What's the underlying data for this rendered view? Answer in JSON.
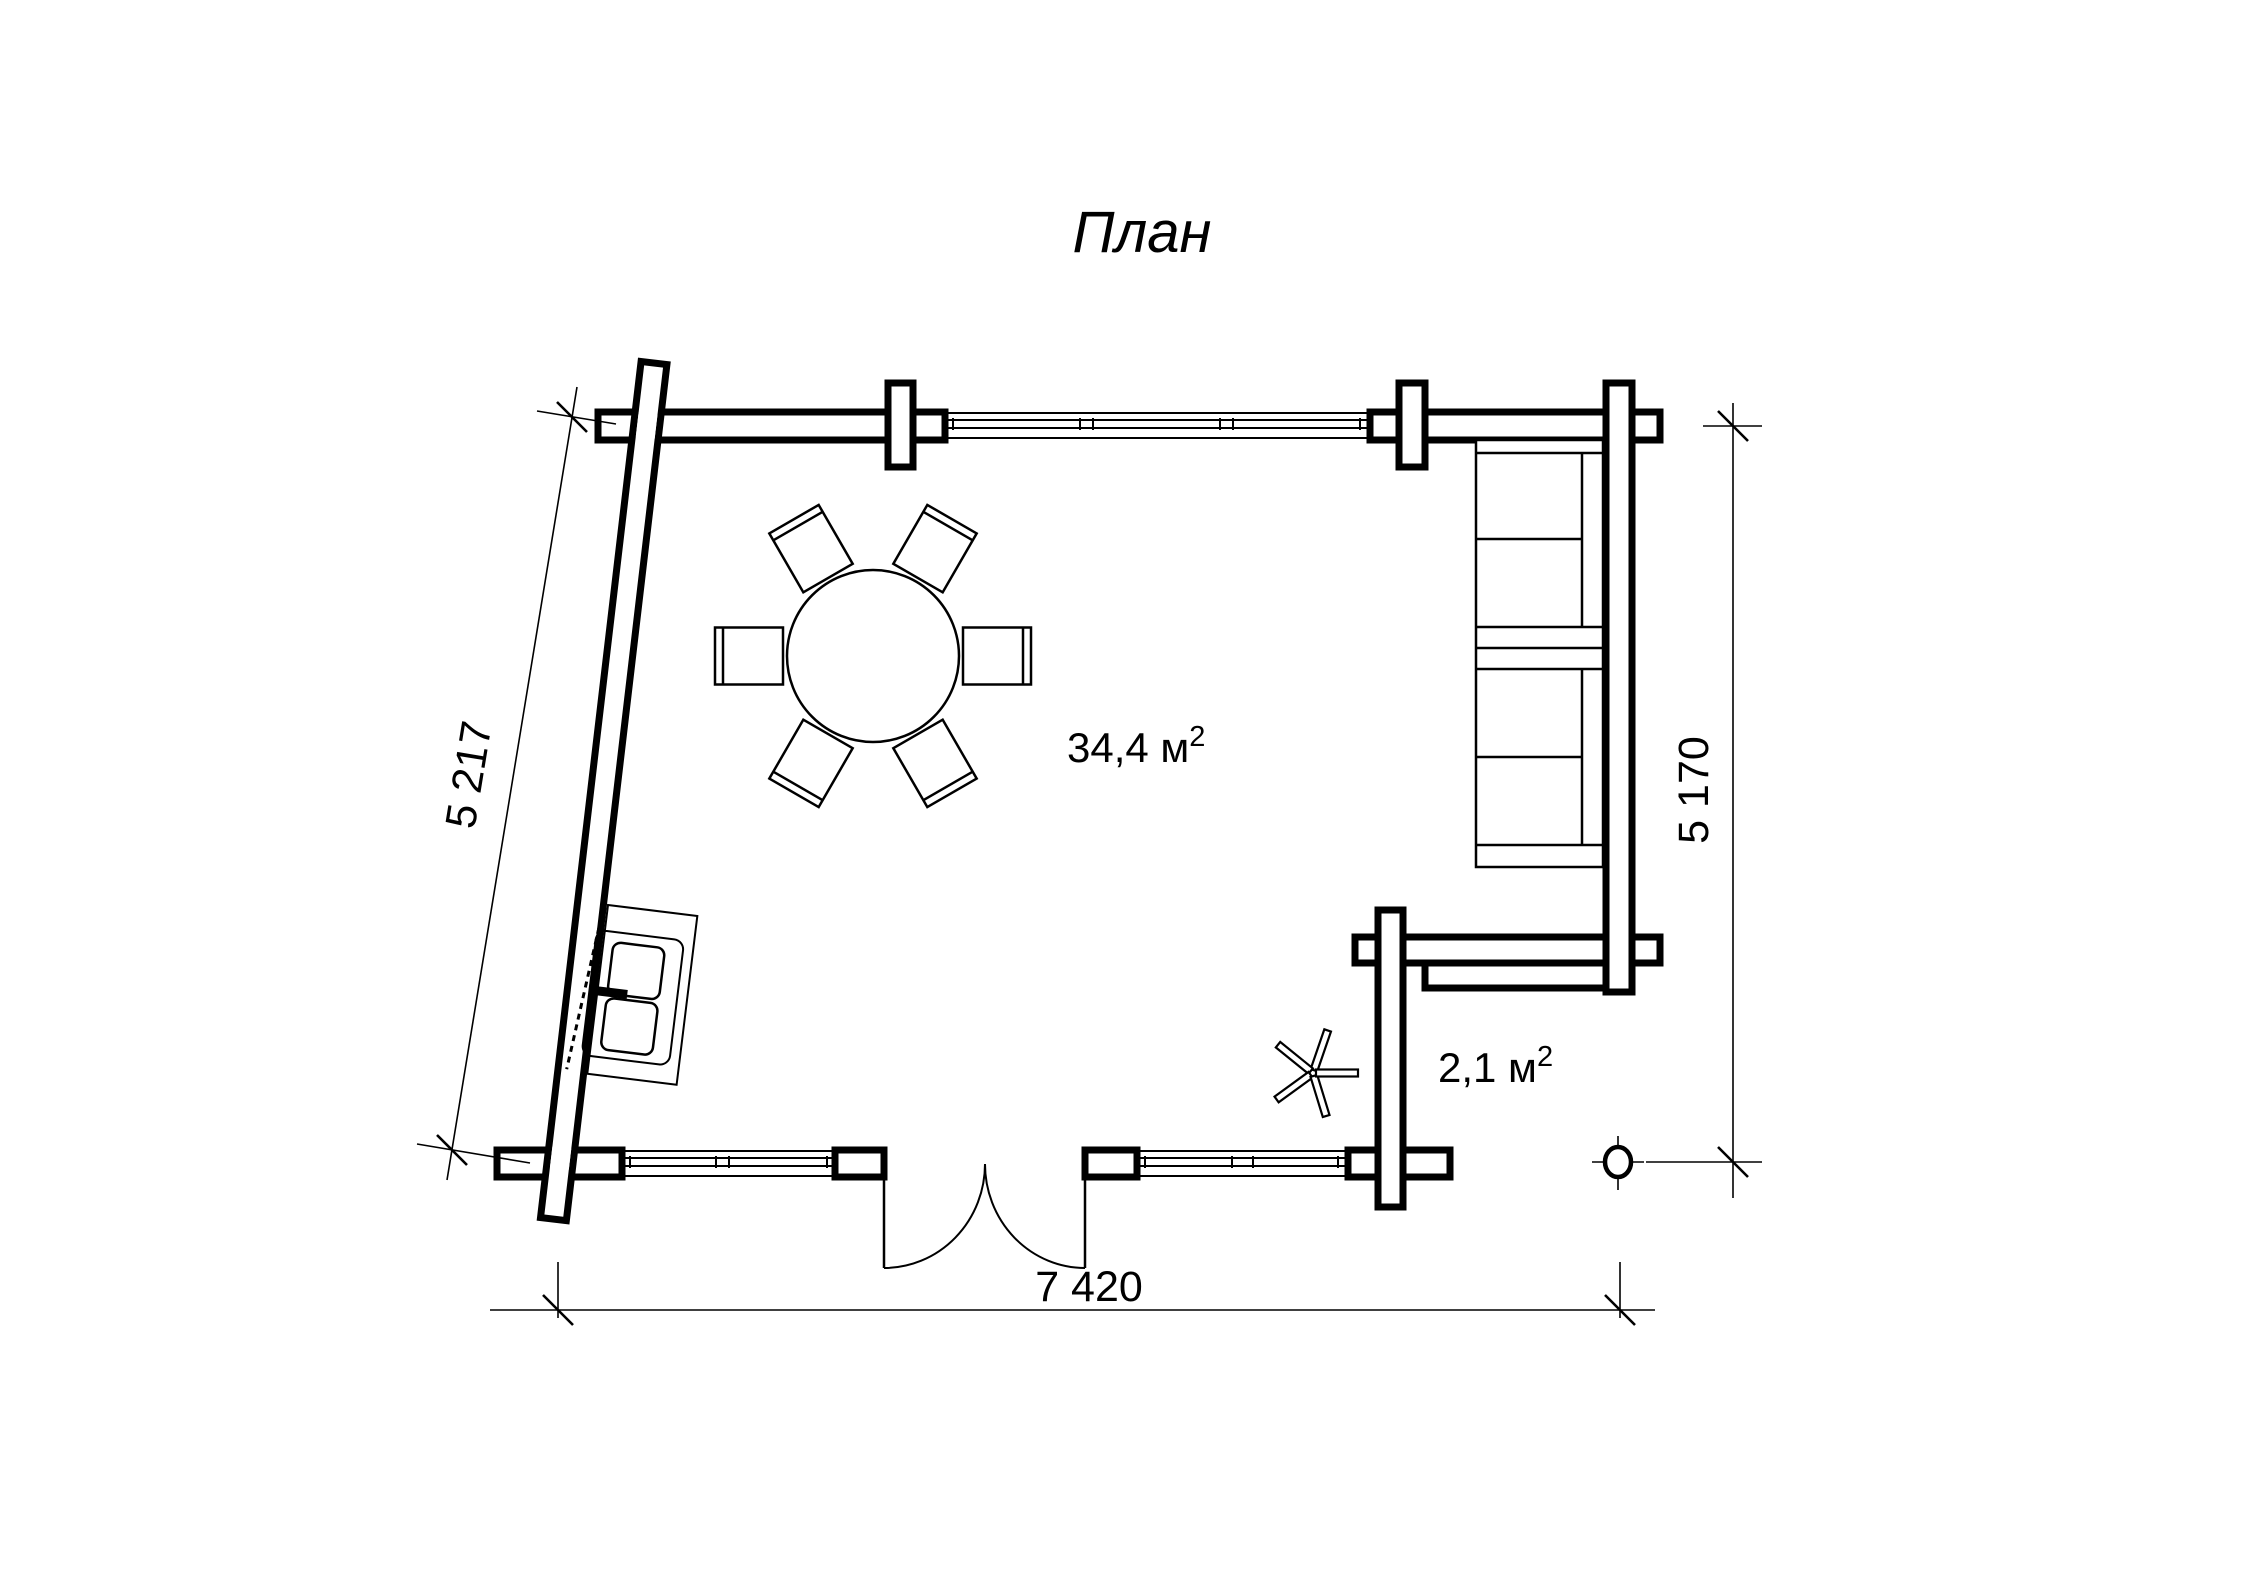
{
  "title": "План",
  "labels": {
    "main_room_area": "34,4 м",
    "main_room_area_sup": "2",
    "porch_area": "2,1 м",
    "porch_area_sup": "2"
  },
  "dimensions": {
    "bottom_width": "7 420",
    "right_height": "5 170",
    "left_slanted": "5 217"
  },
  "symbols": {
    "furniture": [
      "dining-table",
      "chair",
      "sofa",
      "fireplace-stove",
      "ceiling-fan",
      "porch-post"
    ],
    "chair_count": 6,
    "window_count": 3,
    "door_type": "double-door"
  },
  "colors": {
    "line": "#000000",
    "background": "#ffffff"
  }
}
